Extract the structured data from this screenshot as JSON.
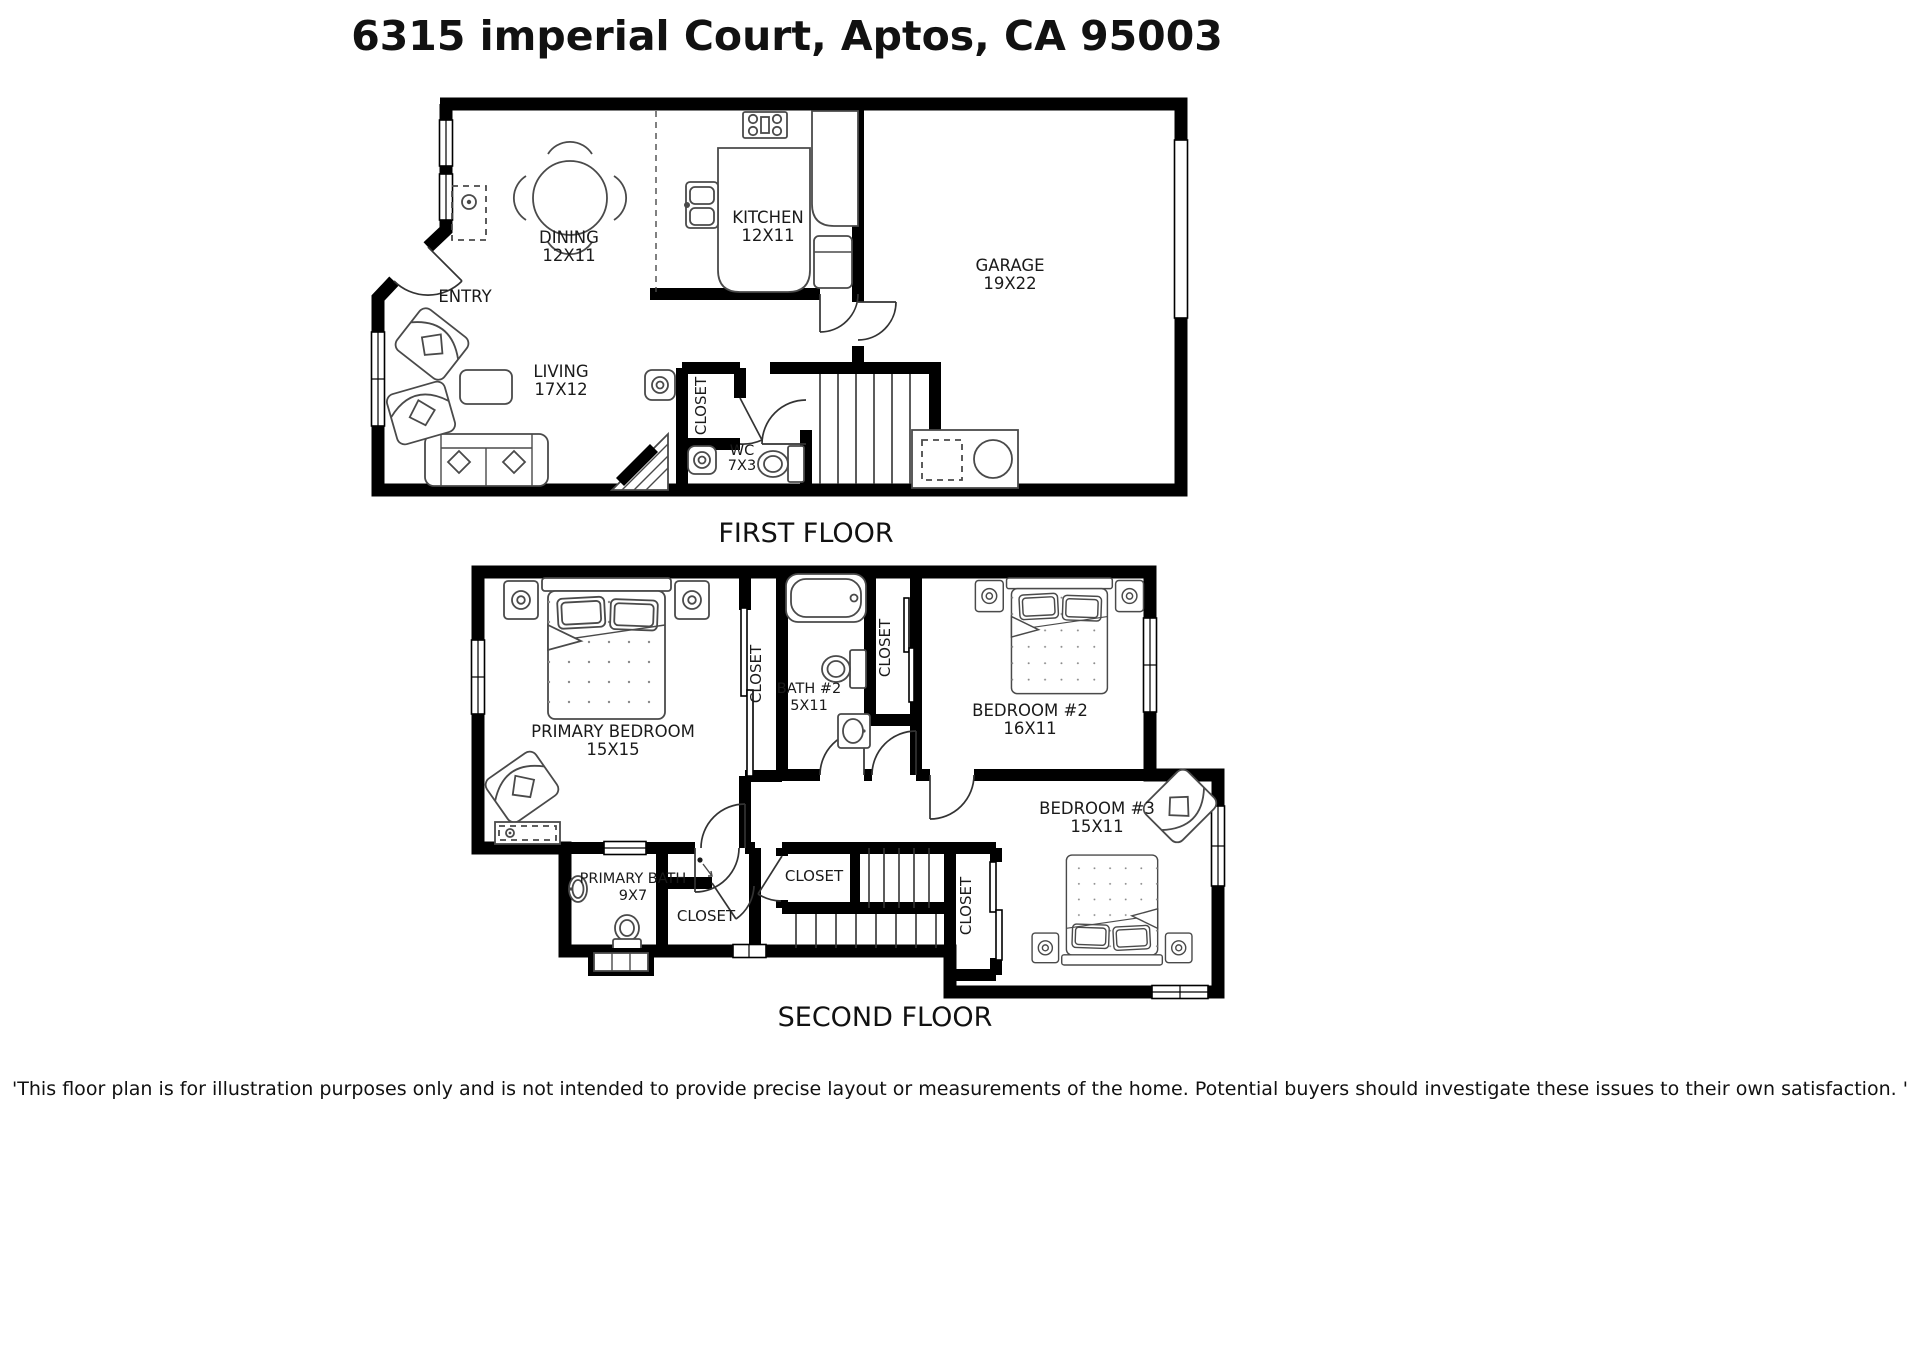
{
  "page": {
    "title": "6315 imperial Court, Aptos, CA 95003",
    "disclaimer": "'This floor plan is for illustration purposes only and is not intended to provide precise layout or measurements of the home. Potential buyers should investigate these issues to their own satisfaction. '"
  },
  "first_floor": {
    "caption": "FIRST FLOOR",
    "rooms": {
      "dining": {
        "name": "DINING",
        "size": "12X11"
      },
      "kitchen": {
        "name": "KITCHEN",
        "size": "12X11"
      },
      "garage": {
        "name": "GARAGE",
        "size": "19X22"
      },
      "entry": {
        "name": "ENTRY"
      },
      "living": {
        "name": "LIVING",
        "size": "17X12"
      },
      "closet": {
        "name": "CLOSET"
      },
      "wc": {
        "name": "WC",
        "size": "7X3"
      }
    }
  },
  "second_floor": {
    "caption": "SECOND FLOOR",
    "rooms": {
      "primary_bedroom": {
        "name": "PRIMARY BEDROOM",
        "size": "15X15"
      },
      "primary_closet": {
        "name": "CLOSET"
      },
      "bath2": {
        "name": "BATH #2",
        "size": "5X11"
      },
      "bath2_closet": {
        "name": "CLOSET"
      },
      "bedroom2": {
        "name": "BEDROOM #2",
        "size": "16X11"
      },
      "bedroom3": {
        "name": "BEDROOM #3",
        "size": "15X11"
      },
      "primary_bath": {
        "name": "PRIMARY BATH",
        "size": "9X7"
      },
      "stair_closet": {
        "name": "CLOSET"
      },
      "walkin_closet": {
        "name": "CLOSET"
      },
      "bedroom3_closet": {
        "name": "CLOSET"
      }
    }
  }
}
